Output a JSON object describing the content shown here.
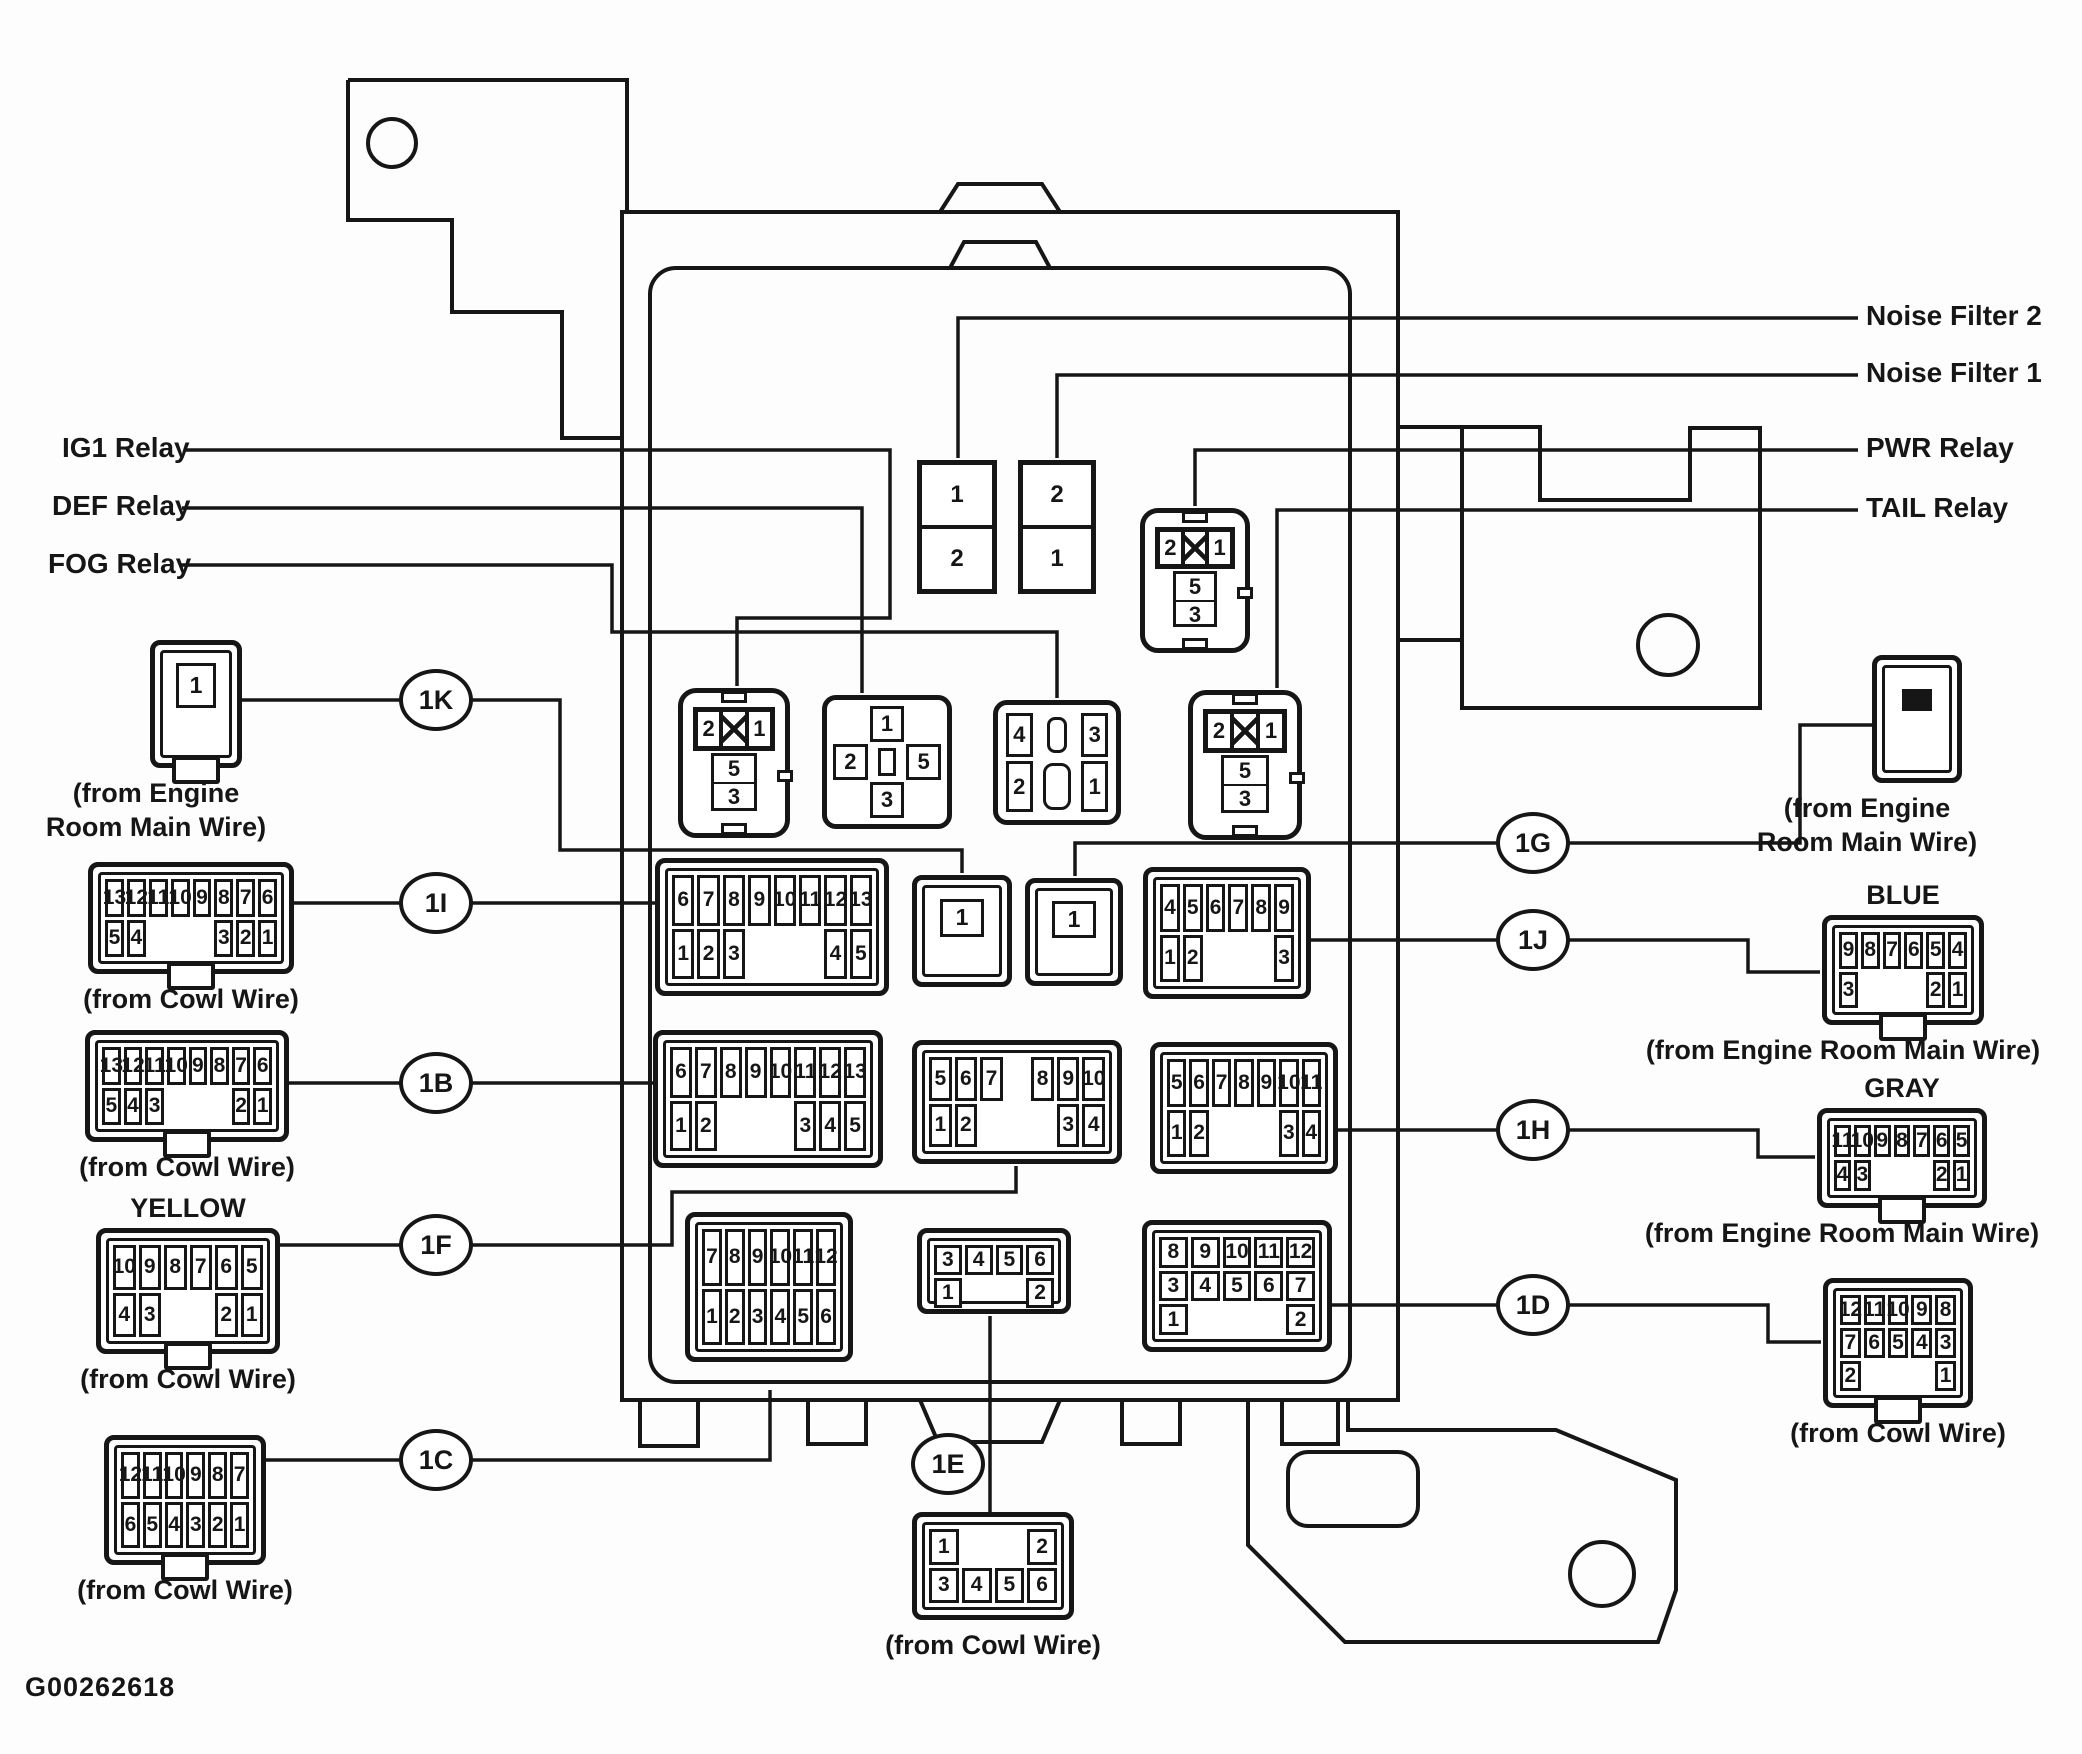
{
  "figure_id": "G00262618",
  "labels": [
    {
      "id": "ig1-relay-label",
      "text": "IG1 Relay",
      "x": 62,
      "y": 432
    },
    {
      "id": "def-relay-label",
      "text": "DEF Relay",
      "x": 52,
      "y": 490
    },
    {
      "id": "fog-relay-label",
      "text": "FOG Relay",
      "x": 48,
      "y": 548
    },
    {
      "id": "noise-filter-2-label",
      "text": "Noise Filter 2",
      "x": 1866,
      "y": 300
    },
    {
      "id": "noise-filter-1-label",
      "text": "Noise Filter 1",
      "x": 1866,
      "y": 357
    },
    {
      "id": "pwr-relay-label",
      "text": "PWR Relay",
      "x": 1866,
      "y": 432
    },
    {
      "id": "tail-relay-label",
      "text": "TAIL Relay",
      "x": 1866,
      "y": 492
    }
  ],
  "callouts": [
    {
      "label": "1K",
      "cx": 436,
      "cy": 700
    },
    {
      "label": "1I",
      "cx": 436,
      "cy": 903
    },
    {
      "label": "1B",
      "cx": 436,
      "cy": 1083
    },
    {
      "label": "1F",
      "cx": 436,
      "cy": 1245
    },
    {
      "label": "1C",
      "cx": 436,
      "cy": 1460
    },
    {
      "label": "1E",
      "cx": 948,
      "cy": 1464
    },
    {
      "label": "1G",
      "cx": 1533,
      "cy": 843
    },
    {
      "label": "1J",
      "cx": 1533,
      "cy": 940
    },
    {
      "label": "1H",
      "cx": 1533,
      "cy": 1130
    },
    {
      "label": "1D",
      "cx": 1533,
      "cy": 1305
    }
  ],
  "connectors": [
    {
      "id": "1k-external",
      "kind": "single",
      "x": 150,
      "y": 640,
      "w": 92,
      "h": 128,
      "pin": "1",
      "latch": true,
      "caption": [
        "(from Engine",
        "Room Main Wire)"
      ],
      "cap_dx": -40
    },
    {
      "id": "1i-external",
      "kind": "grid",
      "x": 88,
      "y": 862,
      "w": 206,
      "h": 112,
      "latch": true,
      "rows": [
        [
          "13",
          "12",
          "11",
          "10",
          "9",
          "8",
          "7",
          "6"
        ],
        [
          "5",
          "4",
          "",
          "",
          "",
          "3",
          "2",
          "1"
        ]
      ],
      "caption": [
        "(from Cowl Wire)"
      ]
    },
    {
      "id": "1b-external",
      "kind": "grid",
      "x": 85,
      "y": 1030,
      "w": 204,
      "h": 112,
      "latch": true,
      "rows": [
        [
          "13",
          "12",
          "11",
          "10",
          "9",
          "8",
          "7",
          "6"
        ],
        [
          "5",
          "4",
          "3",
          "",
          "",
          "",
          "2",
          "1"
        ]
      ],
      "caption": [
        "(from Cowl Wire)"
      ]
    },
    {
      "id": "1f-external",
      "kind": "grid",
      "x": 96,
      "y": 1228,
      "w": 184,
      "h": 126,
      "latch": true,
      "label_top": "YELLOW",
      "rows": [
        [
          "10",
          "9",
          "8",
          "7",
          "6",
          "5"
        ],
        [
          "4",
          "3",
          "",
          "",
          "2",
          "1"
        ]
      ],
      "caption": [
        "(from Cowl Wire)"
      ]
    },
    {
      "id": "1c-external",
      "kind": "grid",
      "x": 104,
      "y": 1435,
      "w": 162,
      "h": 130,
      "latch": true,
      "rows": [
        [
          "12",
          "11",
          "10",
          "9",
          "8",
          "7"
        ],
        [
          "6",
          "5",
          "4",
          "3",
          "2",
          "1"
        ]
      ],
      "caption": [
        "(from Cowl Wire)"
      ]
    },
    {
      "id": "1e-external",
      "kind": "grid",
      "x": 912,
      "y": 1512,
      "w": 162,
      "h": 108,
      "latch": false,
      "rows": [
        [
          "1",
          "",
          "",
          "2"
        ],
        [
          "3",
          "4",
          "5",
          "6"
        ]
      ],
      "caption": [
        "(from Cowl Wire)"
      ]
    },
    {
      "id": "1g-external",
      "kind": "plug",
      "x": 1872,
      "y": 655,
      "w": 90,
      "h": 128,
      "caption": [
        "(from Engine",
        "Room Main Wire)"
      ],
      "cap_dx": -50
    },
    {
      "id": "blue-external",
      "kind": "grid",
      "x": 1822,
      "y": 915,
      "w": 162,
      "h": 110,
      "latch": true,
      "label_top": "BLUE",
      "rows": [
        [
          "9",
          "8",
          "7",
          "6",
          "5",
          "4"
        ],
        [
          "3",
          "",
          "",
          "",
          "2",
          "1"
        ]
      ],
      "caption": [
        "(from Engine Room Main Wire)"
      ],
      "cap_dx": -60
    },
    {
      "id": "gray-external",
      "kind": "grid",
      "x": 1817,
      "y": 1108,
      "w": 170,
      "h": 100,
      "latch": true,
      "label_top": "GRAY",
      "rows": [
        [
          "11",
          "10",
          "9",
          "8",
          "7",
          "6",
          "5"
        ],
        [
          "4",
          "3",
          "",
          "",
          "",
          "2",
          "1"
        ]
      ],
      "caption": [
        "(from Engine Room Main Wire)"
      ],
      "cap_dx": -60
    },
    {
      "id": "1d-external",
      "kind": "grid",
      "x": 1823,
      "y": 1278,
      "w": 150,
      "h": 130,
      "latch": true,
      "rows": [
        [
          "12",
          "11",
          "10",
          "9",
          "8"
        ],
        [
          "7",
          "6",
          "5",
          "4",
          "3"
        ],
        [
          "2",
          "",
          "",
          "",
          "1"
        ]
      ],
      "caption": [
        "(from Cowl Wire)"
      ]
    },
    {
      "id": "1i-mate",
      "kind": "grid",
      "x": 655,
      "y": 858,
      "w": 234,
      "h": 138,
      "rows": [
        [
          "6",
          "7",
          "8",
          "9",
          "10",
          "11",
          "12",
          "13"
        ],
        [
          "1",
          "2",
          "3",
          "",
          "",
          "",
          "4",
          "5"
        ]
      ]
    },
    {
      "id": "1k-mate",
      "kind": "single",
      "x": 912,
      "y": 875,
      "w": 100,
      "h": 112,
      "pin": "1"
    },
    {
      "id": "1g-mate",
      "kind": "single",
      "x": 1025,
      "y": 878,
      "w": 98,
      "h": 108,
      "pin": "1"
    },
    {
      "id": "1j-mate",
      "kind": "grid",
      "x": 1143,
      "y": 867,
      "w": 168,
      "h": 132,
      "rows": [
        [
          "4",
          "5",
          "6",
          "7",
          "8",
          "9"
        ],
        [
          "1",
          "2",
          "",
          "",
          "",
          "3"
        ]
      ]
    },
    {
      "id": "1b-mate",
      "kind": "grid",
      "x": 653,
      "y": 1030,
      "w": 230,
      "h": 138,
      "rows": [
        [
          "6",
          "7",
          "8",
          "9",
          "10",
          "11",
          "12",
          "13"
        ],
        [
          "1",
          "2",
          "",
          "",
          "",
          "3",
          "4",
          "5"
        ]
      ]
    },
    {
      "id": "1f-mate",
      "kind": "grid",
      "x": 912,
      "y": 1040,
      "w": 210,
      "h": 124,
      "rows": [
        [
          "5",
          "6",
          "7",
          "",
          "8",
          "9",
          "10"
        ],
        [
          "1",
          "2",
          "",
          "",
          "",
          "3",
          "4"
        ]
      ]
    },
    {
      "id": "1h-mate",
      "kind": "grid",
      "x": 1150,
      "y": 1042,
      "w": 188,
      "h": 132,
      "rows": [
        [
          "5",
          "6",
          "7",
          "8",
          "9",
          "10",
          "11"
        ],
        [
          "1",
          "2",
          "",
          "",
          "",
          "3",
          "4"
        ]
      ]
    },
    {
      "id": "1c-mate",
      "kind": "grid",
      "x": 685,
      "y": 1212,
      "w": 168,
      "h": 150,
      "rows": [
        [
          "7",
          "8",
          "9",
          "10",
          "11",
          "12"
        ],
        [
          "1",
          "2",
          "3",
          "4",
          "5",
          "6"
        ]
      ]
    },
    {
      "id": "1e-mate",
      "kind": "grid",
      "x": 917,
      "y": 1228,
      "w": 154,
      "h": 86,
      "rows": [
        [
          "3",
          "4",
          "5",
          "6"
        ],
        [
          "1",
          "",
          "",
          "2"
        ]
      ]
    },
    {
      "id": "1d-mate",
      "kind": "grid",
      "x": 1142,
      "y": 1220,
      "w": 190,
      "h": 132,
      "rows": [
        [
          "8",
          "9",
          "10",
          "11",
          "12"
        ],
        [
          "3",
          "4",
          "5",
          "6",
          "7"
        ],
        [
          "1",
          "",
          "",
          "",
          "2"
        ]
      ]
    },
    {
      "id": "ig1-relay-socket",
      "kind": "relay513",
      "x": 678,
      "y": 688,
      "w": 112,
      "h": 150,
      "pins": {
        "top": [
          "2",
          "1"
        ],
        "stack": [
          "5",
          "3"
        ]
      }
    },
    {
      "id": "def-relay-socket",
      "kind": "cross",
      "x": 822,
      "y": 695,
      "w": 130,
      "h": 134,
      "pins": {
        "top": "1",
        "left": "2",
        "right": "5",
        "bottom": "3"
      }
    },
    {
      "id": "fog-relay-socket",
      "kind": "fog",
      "x": 993,
      "y": 700,
      "w": 128,
      "h": 125,
      "pins": {
        "tl": "4",
        "tr": "3",
        "bl": "2",
        "br": "1"
      }
    },
    {
      "id": "tail-relay-socket",
      "kind": "relay513",
      "x": 1188,
      "y": 690,
      "w": 114,
      "h": 150,
      "pins": {
        "top": [
          "2",
          "1"
        ],
        "stack": [
          "5",
          "3"
        ]
      }
    },
    {
      "id": "pwr-relay-socket",
      "kind": "relay513",
      "x": 1140,
      "y": 508,
      "w": 110,
      "h": 145,
      "pins": {
        "top": [
          "2",
          "1"
        ],
        "stack": [
          "5",
          "3"
        ]
      }
    },
    {
      "id": "noise-filter-2-box",
      "kind": "nf",
      "x": 917,
      "y": 460,
      "w": 80,
      "h": 134,
      "pins": [
        "1",
        "2"
      ]
    },
    {
      "id": "noise-filter-1-box",
      "kind": "nf",
      "x": 1018,
      "y": 460,
      "w": 78,
      "h": 134,
      "pins": [
        "2",
        "1"
      ]
    }
  ]
}
